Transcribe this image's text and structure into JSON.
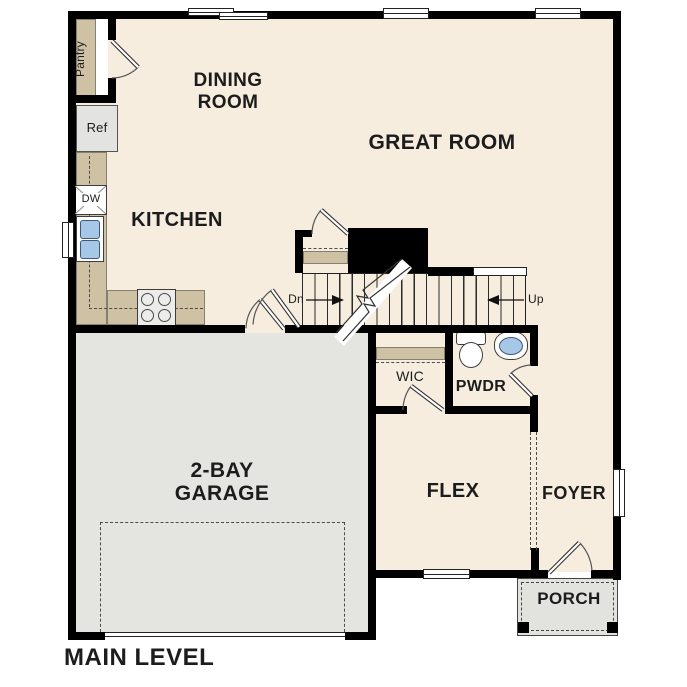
{
  "title": {
    "label": "MAIN LEVEL"
  },
  "rooms": {
    "dining": {
      "line1": "DINING",
      "line2": "ROOM"
    },
    "great": {
      "label": "GREAT ROOM"
    },
    "kitchen": {
      "label": "KITCHEN"
    },
    "garage": {
      "line1": "2-BAY",
      "line2": "GARAGE"
    },
    "flex": {
      "label": "FLEX"
    },
    "foyer": {
      "label": "FOYER"
    },
    "porch": {
      "label": "PORCH"
    },
    "pwdr": {
      "label": "PWDR"
    },
    "wic": {
      "label": "WIC"
    },
    "pantry": {
      "label": "Pantry"
    }
  },
  "fixtures": {
    "ref": {
      "label": "Ref"
    },
    "dw": {
      "label": "DW"
    }
  },
  "stairs": {
    "down": "Dn",
    "up": "Up"
  },
  "colors": {
    "floor": "#f6edde",
    "garage_floor": "#e4e4e1",
    "porch_floor": "#e2e2df",
    "counter": "#cfc1a3",
    "wall": "#000000",
    "sink_blue": "#a6c7e8",
    "appliance": "#e3e3e1",
    "stove": "#ececea",
    "text": "#1c1c1c"
  }
}
